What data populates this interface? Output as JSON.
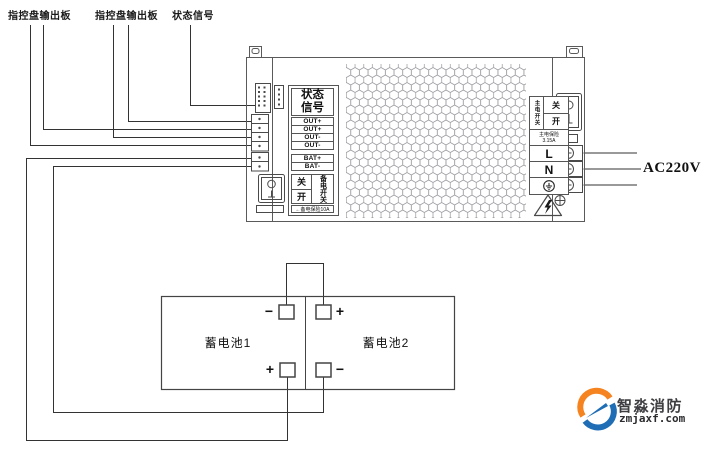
{
  "top_labels": {
    "board1": "指控盘输出板",
    "board2": "指控盘输出板",
    "status": "状态信号"
  },
  "psu": {
    "status_panel_line1": "状态",
    "status_panel_line2": "信号",
    "out_rows": [
      "OUT+",
      "OUT+",
      "OUT-",
      "OUT-"
    ],
    "bat_rows": [
      "BAT+",
      "BAT-"
    ],
    "backup_switch_off": "关",
    "backup_switch_on": "开",
    "backup_switch_name": "备电开关",
    "backup_fuse_note": "←备电保险10A",
    "main_switch_name": "主电开关",
    "main_switch_off": "关",
    "main_switch_on": "开",
    "main_fuse_name": "主电保险",
    "main_fuse_rating": "3.15A",
    "line_terminal": "L",
    "neutral_terminal": "N",
    "ground_icon": "protective-earth"
  },
  "ac_input_label": "AC220V",
  "batteries": {
    "battery1_name": "蓄电池1",
    "battery1_top_polarity": "−",
    "battery1_bottom_polarity": "+",
    "battery2_name": "蓄电池2",
    "battery2_top_polarity": "+",
    "battery2_bottom_polarity": "−"
  },
  "logo": {
    "title": "智淼消防",
    "website": "zmjaxf.com",
    "orange": "#F5831F",
    "blue": "#1E6DB5"
  }
}
